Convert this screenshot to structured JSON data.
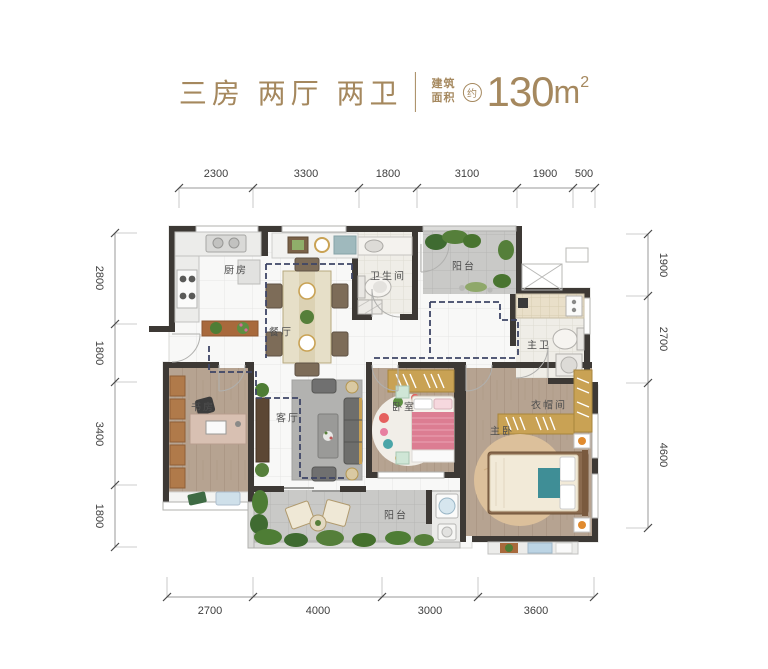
{
  "title": {
    "rooms_label": "三房 两厅 两卫",
    "area_prefix_line1": "建筑",
    "area_prefix_line2": "面积",
    "area_approx": "约",
    "area_number": "130",
    "area_unit": "m",
    "area_exponent": "2"
  },
  "dimensions": {
    "top": [
      "2300",
      "3300",
      "1800",
      "3100",
      "1900",
      "500"
    ],
    "left": [
      "2800",
      "1800",
      "3400",
      "1800"
    ],
    "right": [
      "1900",
      "2700",
      "4600"
    ],
    "bottom": [
      "2700",
      "4000",
      "3000",
      "3600"
    ]
  },
  "rooms": {
    "kitchen": "厨房",
    "dining": "餐厅",
    "bathroom": "卫生间",
    "balcony_top": "阳台",
    "master_bath": "主卫",
    "study": "书房",
    "living": "客厅",
    "bedroom": "卧室",
    "master_bedroom": "主卧",
    "closet": "衣帽间",
    "balcony_bottom": "阳台"
  },
  "colors": {
    "accent_gold": "#a5885e",
    "wall": "#3d3935",
    "dashed_route": "#3e4566",
    "dimension_text": "#3e3e3e"
  }
}
